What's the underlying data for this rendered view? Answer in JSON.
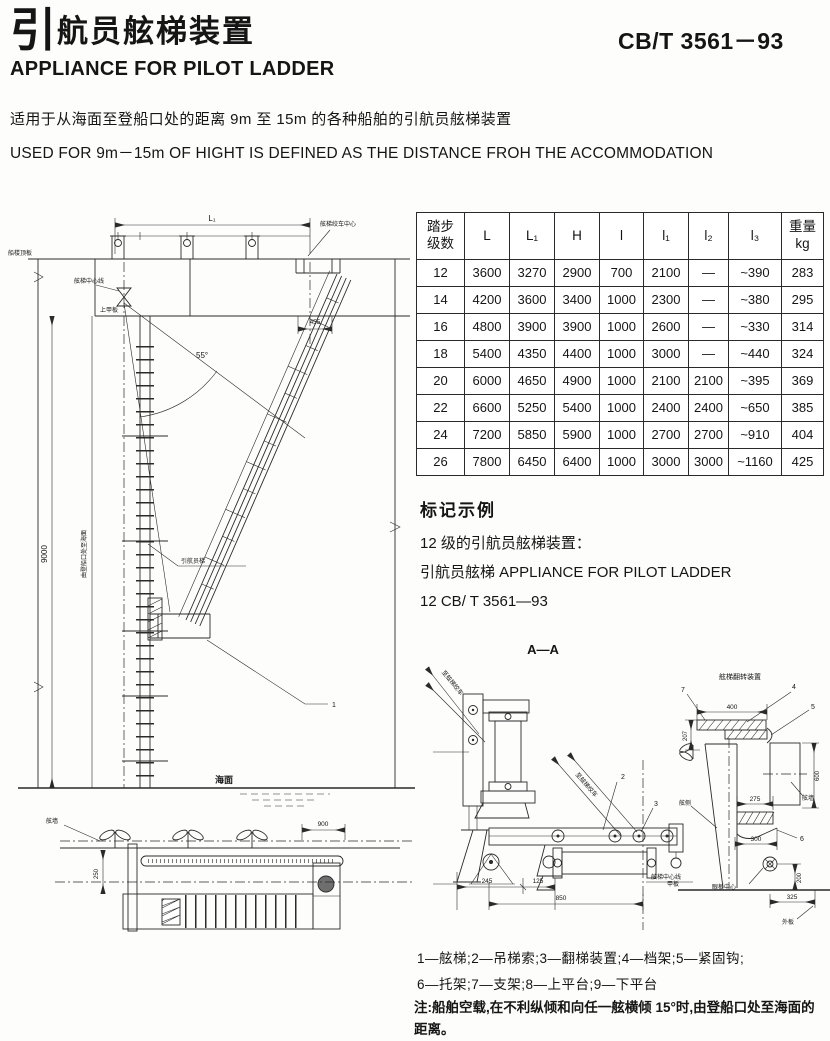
{
  "header": {
    "title_zh_big": "引",
    "title_zh_rest": "航员舷梯装置",
    "title_en": "APPLIANCE FOR PILOT LADDER",
    "standard_code": "CB/T 3561－93"
  },
  "intro": {
    "zh": "适用于从海面至登船口处的距离 9m 至 15m 的各种船舶的引航员舷梯装置",
    "en": "USED FOR 9m－15m OF HIGHT IS DEFINED AS THE DISTANCE FROH THE ACCOMMODATION"
  },
  "table": {
    "col0_line1": "踏步",
    "col0_line2": "级数",
    "cols": [
      "L",
      "L₁",
      "H",
      "l",
      "l₁",
      "l₂",
      "l₃"
    ],
    "weight_line1": "重量",
    "weight_line2": "kg",
    "rows": [
      [
        "12",
        "3600",
        "3270",
        "2900",
        "700",
        "2100",
        "—",
        "~390",
        "283"
      ],
      [
        "14",
        "4200",
        "3600",
        "3400",
        "1000",
        "2300",
        "—",
        "~380",
        "295"
      ],
      [
        "16",
        "4800",
        "3900",
        "3900",
        "1000",
        "2600",
        "—",
        "~330",
        "314"
      ],
      [
        "18",
        "5400",
        "4350",
        "4400",
        "1000",
        "3000",
        "—",
        "~440",
        "324"
      ],
      [
        "20",
        "6000",
        "4650",
        "4900",
        "1000",
        "2100",
        "2100",
        "~395",
        "369"
      ],
      [
        "22",
        "6600",
        "5250",
        "5400",
        "1000",
        "2400",
        "2400",
        "~650",
        "385"
      ],
      [
        "24",
        "7200",
        "5850",
        "5900",
        "1000",
        "2700",
        "2700",
        "~910",
        "404"
      ],
      [
        "26",
        "7800",
        "6450",
        "6400",
        "1000",
        "3000",
        "3000",
        "~1160",
        "425"
      ]
    ]
  },
  "marking": {
    "heading": "标记示例",
    "line1": "12 级的引航员舷梯装置：",
    "line2": "引航员舷梯 APPLIANCE FOR PILOT LADDER",
    "line3": "12 CB/ T 3561—93"
  },
  "legend": {
    "line1": "1—舷梯;2—吊梯索;3—翻梯装置;4—档架;5—紧固钩;",
    "line2": "6—托架;7—支架;8—上平台;9—下平台"
  },
  "note": {
    "prefix": "注:",
    "text": "船舶空载,在不利纵倾和向任一舷横倾 15°时,由登船口处至海面的距离。"
  },
  "main_drawing": {
    "dim_L1": "L₁",
    "dim_9000": "9000",
    "dim_455": "455",
    "angle": "55°",
    "label_boat_deck": "船楼顶板",
    "label_upper_deck": "上甲板",
    "label_cl": "舷梯中心线",
    "label_winch": "舷梯绞车中心",
    "label_height": "由登船口处至海面",
    "label_ladder": "引航员梯",
    "label_sea": "海面",
    "callout_1": "1",
    "plan": {
      "dim_900": "900",
      "dim_250": "250",
      "label_bulwark": "舷墙"
    }
  },
  "section_drawing": {
    "title": "A—A",
    "label_to_winch": "至舷梯绞车",
    "callouts": {
      "c2": "2",
      "c3": "3",
      "c4": "4",
      "c5": "5",
      "c6": "6",
      "c7": "7"
    },
    "dims": {
      "d245": "245",
      "d125": "125",
      "d850": "850",
      "d400": "400",
      "d207": "207",
      "d600": "600",
      "d275": "275",
      "d300": "300",
      "d200": "200",
      "d325": "325"
    },
    "labels": {
      "cl": "舷梯中心线",
      "detail_title": "舷梯翻转装置",
      "side": "舷侧",
      "bulwark": "舷墙",
      "deck": "甲板",
      "shell": "外板",
      "eye": "眼板中心"
    }
  }
}
